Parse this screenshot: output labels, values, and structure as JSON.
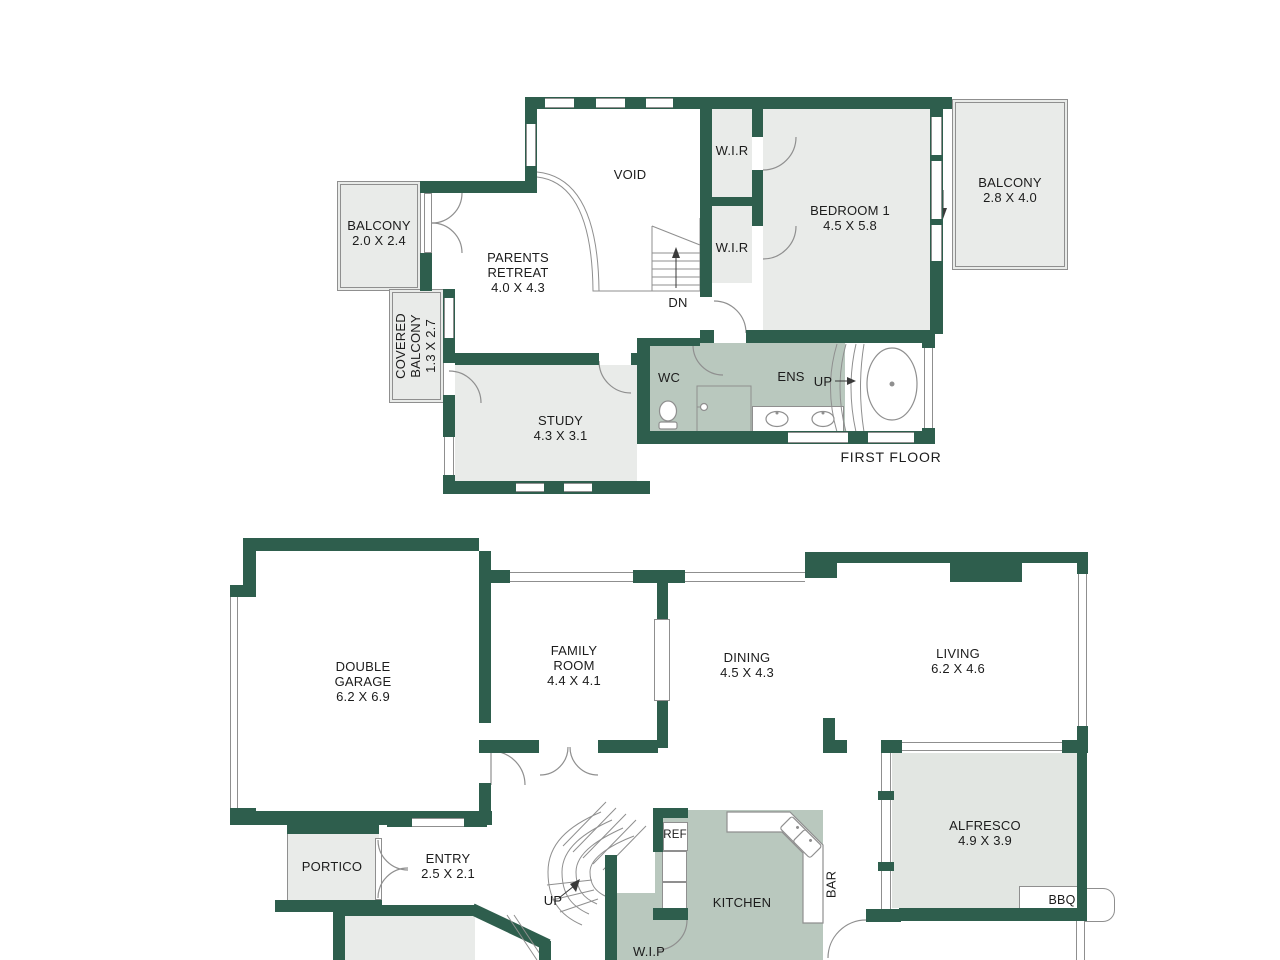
{
  "colors": {
    "wall": "#2e5e4d",
    "line": "#8f8f8f",
    "text": "#1c1c1c",
    "room_gray": "#e9ebe9",
    "room_sage": "#b9c8be",
    "alfresco_fill": "#e2e6e2"
  },
  "first_floor": {
    "floor_label": "FIRST FLOOR",
    "balcony_left": {
      "name": "BALCONY",
      "dims": "2.0 X 2.4"
    },
    "covered_balcony": {
      "line1": "COVERED",
      "line2": "BALCONY",
      "dims": "1.3 X 2.7"
    },
    "parents_retreat": {
      "line1": "PARENTS",
      "line2": "RETREAT",
      "dims": "4.0 X 4.3"
    },
    "void_label": "VOID",
    "wir_top": "W.I.R",
    "wir_bottom": "W.I.R",
    "bedroom1": {
      "name": "BEDROOM 1",
      "dims": "4.5 X 5.8"
    },
    "balcony_right": {
      "name": "BALCONY",
      "dims": "2.8 X 4.0"
    },
    "study": {
      "name": "STUDY",
      "dims": "4.3 X 3.1"
    },
    "wc_label": "WC",
    "ens_label": "ENS",
    "up_label": "UP",
    "dn_label": "DN"
  },
  "ground_floor": {
    "double_garage": {
      "line1": "DOUBLE",
      "line2": "GARAGE",
      "dims": "6.2 X 6.9"
    },
    "family_room": {
      "line1": "FAMILY",
      "line2": "ROOM",
      "dims": "4.4 X 4.1"
    },
    "dining": {
      "name": "DINING",
      "dims": "4.5 X 4.3"
    },
    "living": {
      "name": "LIVING",
      "dims": "6.2 X 4.6"
    },
    "alfresco": {
      "name": "ALFRESCO",
      "dims": "4.9 X 3.9"
    },
    "bbq_label": "BBQ",
    "bar_label": "BAR",
    "kitchen_label": "KITCHEN",
    "ref_label": "REF",
    "wip_label": "W.I.P",
    "portico_label": "PORTICO",
    "entry": {
      "name": "ENTRY",
      "dims": "2.5 X 2.1"
    },
    "up_label": "UP"
  }
}
